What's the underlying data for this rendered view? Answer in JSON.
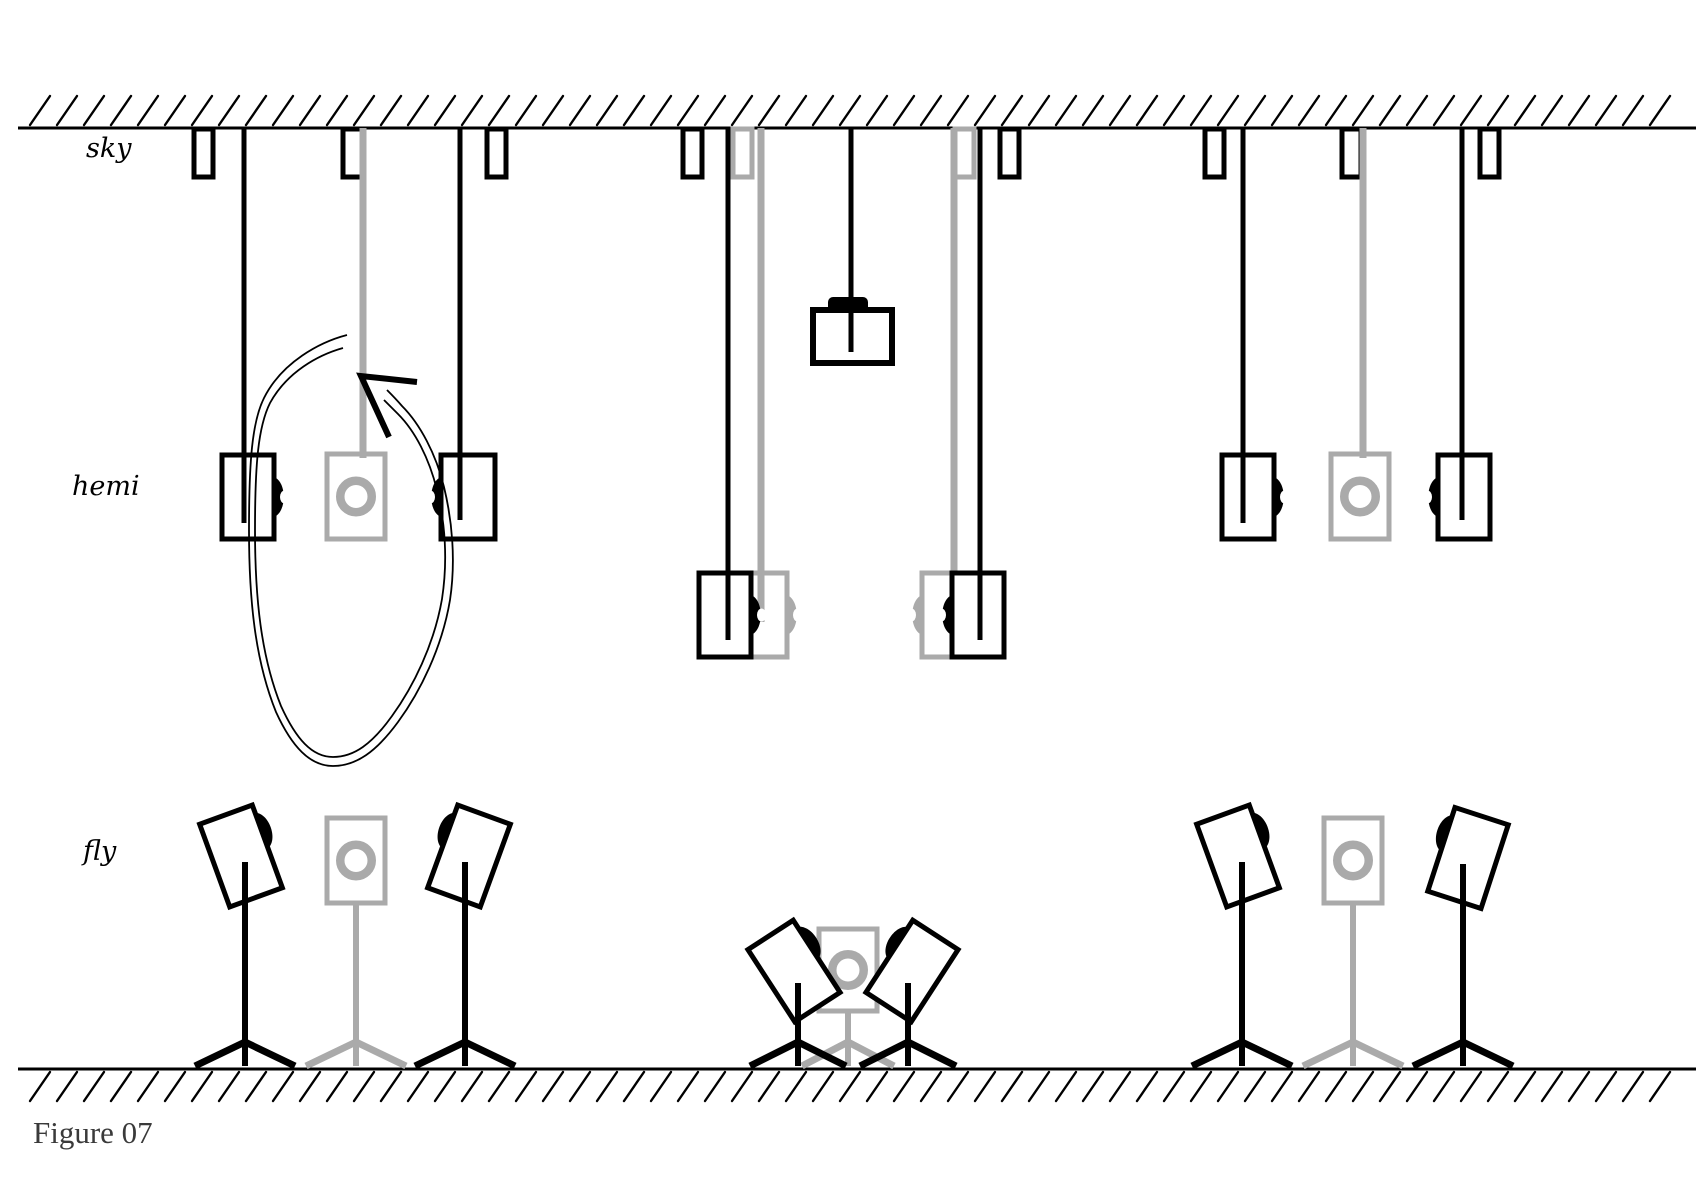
{
  "figure": {
    "caption": "Figure 07"
  },
  "row_labels": [
    {
      "id": "sky",
      "text": "sky"
    },
    {
      "id": "hemi",
      "text": "hemi"
    },
    {
      "id": "fly",
      "text": "fly"
    }
  ],
  "colors": {
    "ink": "#000000",
    "gray": "#aaaaaa",
    "caption": "#3a3a3a",
    "paper": "#ffffff"
  },
  "scene": {
    "ceiling": {
      "y": 128,
      "x1": 18,
      "x2": 1696
    },
    "floor": {
      "y": 1069,
      "x1": 18,
      "x2": 1696
    },
    "hatch": {
      "step": 27,
      "dx": 20,
      "dy": 29,
      "width": 2.4
    },
    "bracket_size": {
      "w": 19,
      "h": 48,
      "top": 129
    },
    "brackets": [
      {
        "x": 194,
        "color": "ink"
      },
      {
        "x": 343,
        "color": "ink"
      },
      {
        "x": 487,
        "color": "ink"
      },
      {
        "x": 683,
        "color": "ink"
      },
      {
        "x": 733,
        "color": "gray"
      },
      {
        "x": 955,
        "color": "gray"
      },
      {
        "x": 1000,
        "color": "ink"
      },
      {
        "x": 1205,
        "color": "ink"
      },
      {
        "x": 1342,
        "color": "ink"
      },
      {
        "x": 1480,
        "color": "ink"
      }
    ],
    "cables": [
      {
        "x": 244,
        "to": 523,
        "color": "ink"
      },
      {
        "x": 363,
        "to": 458,
        "color": "gray"
      },
      {
        "x": 460,
        "to": 520,
        "color": "ink"
      },
      {
        "x": 728,
        "to": 640,
        "color": "ink"
      },
      {
        "x": 761,
        "to": 622,
        "color": "gray"
      },
      {
        "x": 851,
        "to": 352,
        "color": "ink"
      },
      {
        "x": 954,
        "to": 622,
        "color": "gray"
      },
      {
        "x": 980,
        "to": 640,
        "color": "ink"
      },
      {
        "x": 1243,
        "to": 523,
        "color": "ink"
      },
      {
        "x": 1363,
        "to": 458,
        "color": "gray"
      },
      {
        "x": 1462,
        "to": 520,
        "color": "ink"
      }
    ],
    "hung_speakers_side": [
      {
        "x": 731,
        "y": 573,
        "w": 56,
        "h": 84,
        "face": "right",
        "color": "gray"
      },
      {
        "x": 922,
        "y": 573,
        "w": 56,
        "h": 84,
        "face": "left",
        "color": "gray"
      },
      {
        "x": 222,
        "y": 455,
        "w": 52,
        "h": 84,
        "face": "right",
        "color": "ink"
      },
      {
        "x": 441,
        "y": 455,
        "w": 54,
        "h": 84,
        "face": "left",
        "color": "ink"
      },
      {
        "x": 699,
        "y": 573,
        "w": 52,
        "h": 84,
        "face": "right",
        "color": "ink"
      },
      {
        "x": 952,
        "y": 573,
        "w": 52,
        "h": 84,
        "face": "left",
        "color": "ink"
      },
      {
        "x": 1222,
        "y": 455,
        "w": 52,
        "h": 84,
        "face": "right",
        "color": "ink"
      },
      {
        "x": 1438,
        "y": 455,
        "w": 52,
        "h": 84,
        "face": "left",
        "color": "ink"
      }
    ],
    "hung_speakers_back": [
      {
        "x": 327,
        "y": 454,
        "w": 58,
        "h": 85
      },
      {
        "x": 1331,
        "y": 454,
        "w": 58,
        "h": 85
      }
    ],
    "subwoofer": {
      "x": 813,
      "y": 310,
      "w": 79,
      "h": 53,
      "mound": {
        "x": 828,
        "y": 297,
        "w": 40,
        "h": 15
      }
    },
    "stands": [
      {
        "pole_x": 356,
        "color": "gray",
        "pole_top": 903,
        "spread": 50,
        "speaker": {
          "kind": "back",
          "x": 327,
          "y": 818,
          "w": 58,
          "h": 85
        }
      },
      {
        "pole_x": 848,
        "color": "gray",
        "pole_top": 1011,
        "spread": 46,
        "speaker": {
          "kind": "back",
          "x": 819,
          "y": 929,
          "w": 58,
          "h": 82
        }
      },
      {
        "pole_x": 1353,
        "color": "gray",
        "pole_top": 903,
        "spread": 50,
        "speaker": {
          "kind": "back",
          "x": 1324,
          "y": 818,
          "w": 58,
          "h": 85
        }
      },
      {
        "pole_x": 245,
        "color": "ink",
        "pole_top": 862,
        "spread": 50,
        "speaker": {
          "kind": "tilted",
          "cx": 241,
          "cy": 856,
          "w": 56,
          "h": 88,
          "rot": -20,
          "face": "right"
        }
      },
      {
        "pole_x": 465,
        "color": "ink",
        "pole_top": 862,
        "spread": 50,
        "speaker": {
          "kind": "tilted",
          "cx": 469,
          "cy": 856,
          "w": 56,
          "h": 88,
          "rot": 20,
          "face": "left"
        }
      },
      {
        "pole_x": 798,
        "color": "ink",
        "pole_top": 983,
        "spread": 48,
        "speaker": {
          "kind": "tilted",
          "cx": 794,
          "cy": 971,
          "w": 54,
          "h": 86,
          "rot": -33,
          "face": "right"
        }
      },
      {
        "pole_x": 908,
        "color": "ink",
        "pole_top": 983,
        "spread": 48,
        "speaker": {
          "kind": "tilted",
          "cx": 912,
          "cy": 971,
          "w": 54,
          "h": 86,
          "rot": 33,
          "face": "left"
        }
      },
      {
        "pole_x": 1242,
        "color": "ink",
        "pole_top": 862,
        "spread": 50,
        "speaker": {
          "kind": "tilted",
          "cx": 1238,
          "cy": 856,
          "w": 56,
          "h": 88,
          "rot": -20,
          "face": "right"
        }
      },
      {
        "pole_x": 1463,
        "color": "ink",
        "pole_top": 864,
        "spread": 50,
        "speaker": {
          "kind": "tilted",
          "cx": 1468,
          "cy": 858,
          "w": 56,
          "h": 88,
          "rot": 18,
          "face": "left"
        }
      }
    ],
    "stand_base": {
      "junction_y": 1042,
      "foot_y": 1066,
      "pole_bottom": 1058
    },
    "loop_annotation": {
      "outer": "M 347 335 C 320 342 282 362 264 398 C 252 422 249 462 249 530 C 249 600 255 660 276 712 C 292 747 310 766 333 766 C 356 766 376 752 398 722 C 420 692 442 648 450 600 C 456 560 452 520 444 487 C 436 454 420 424 402 406 C 396 399 391 394 387 390",
      "inner": "M 343 348 C 318 355 287 372 270 403 C 258 427 255 465 255 530 C 255 598 261 656 281 706 C 296 739 312 757 333 757 C 354 757 372 744 392 716 C 413 687 434 645 442 599 C 448 560 445 522 437 490 C 429 458 415 431 398 414 C 393 409 388 404 384 400",
      "arrow": "M 417 382 L 361 376 L 389 437",
      "stroke": 1.8,
      "arrow_stroke": 6
    }
  }
}
